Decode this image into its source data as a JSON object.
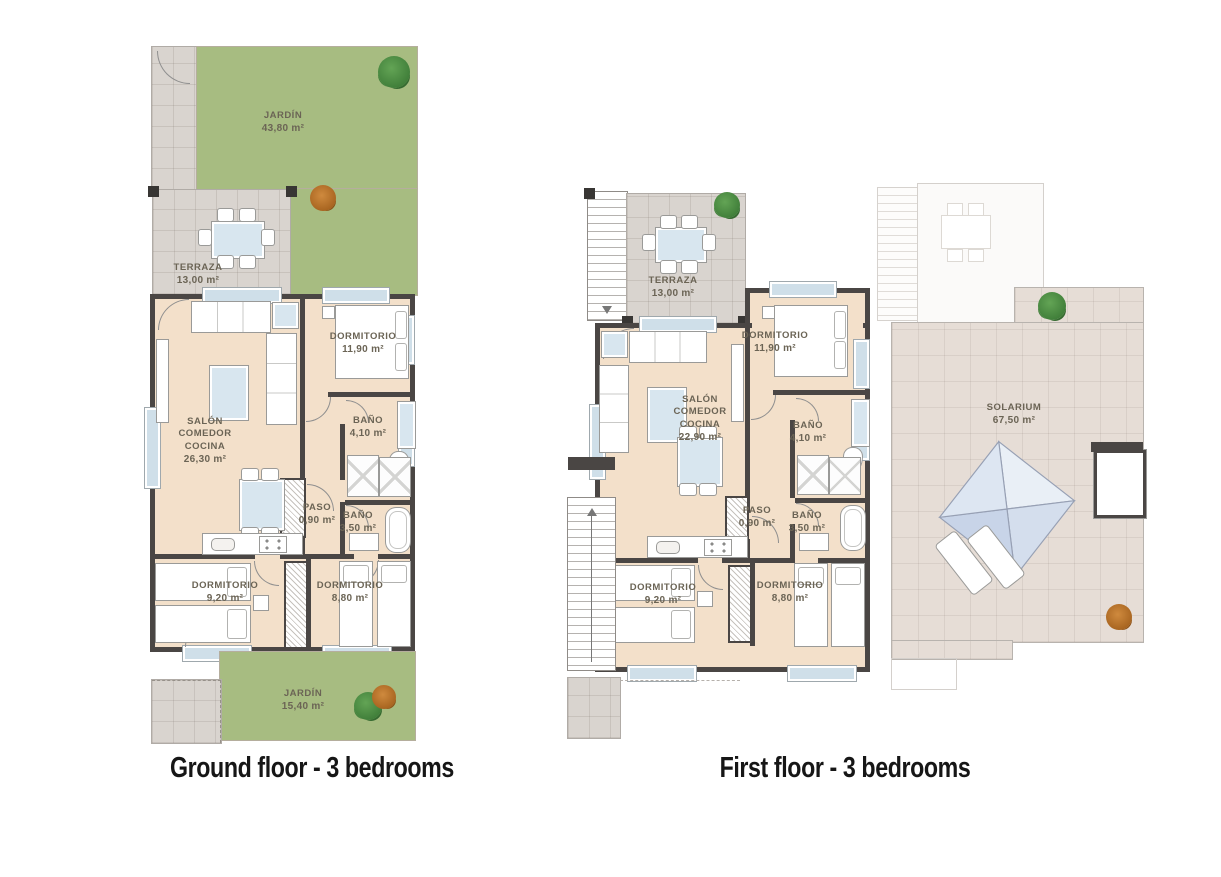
{
  "ground_floor": {
    "caption": "Ground floor - 3 bedrooms",
    "rooms": {
      "jardin_top": {
        "name": "JARDÍN",
        "area": "43,80 m²"
      },
      "terraza": {
        "name": "TERRAZA",
        "area": "13,00 m²"
      },
      "salon": {
        "name": "SALÓN COMEDOR COCINA",
        "area": "26,30 m²"
      },
      "dormitorio1": {
        "name": "DORMITORIO",
        "area": "11,90 m²"
      },
      "bano1": {
        "name": "BAÑO",
        "area": "4,10 m²"
      },
      "paso": {
        "name": "PASO",
        "area": "0,90 m²"
      },
      "bano2": {
        "name": "BAÑO",
        "area": "3,50 m²"
      },
      "dormitorio2": {
        "name": "DORMITORIO",
        "area": "9,20 m²"
      },
      "dormitorio3": {
        "name": "DORMITORIO",
        "area": "8,80 m²"
      },
      "jardin_bottom": {
        "name": "JARDÍN",
        "area": "15,40 m²"
      }
    }
  },
  "first_floor": {
    "caption": "First floor - 3 bedrooms",
    "rooms": {
      "terraza": {
        "name": "TERRAZA",
        "area": "13,00 m²"
      },
      "salon": {
        "name": "SALÓN COMEDOR COCINA",
        "area": "22,90 m²"
      },
      "dormitorio1": {
        "name": "DORMITORIO",
        "area": "11,90 m²"
      },
      "bano1": {
        "name": "BAÑO",
        "area": "4,10 m²"
      },
      "paso": {
        "name": "PASO",
        "area": "0,90 m²"
      },
      "bano2": {
        "name": "BAÑO",
        "area": "3,50 m²"
      },
      "dormitorio2": {
        "name": "DORMITORIO",
        "area": "9,20 m²"
      },
      "dormitorio3": {
        "name": "DORMITORIO",
        "area": "8,80 m²"
      },
      "solarium": {
        "name": "SOLARIUM",
        "area": "67,50 m²"
      }
    }
  },
  "colors": {
    "garden_green": "#a7bc81",
    "terrace_tile": "#d9d4cf",
    "interior_floor": "#f3e0ca",
    "wall_dark": "#4a4644",
    "solarium_tile": "#e6ddd6",
    "window_glass": "#cfdfe9",
    "label_text": "#6b6455",
    "caption_text": "#161616"
  }
}
